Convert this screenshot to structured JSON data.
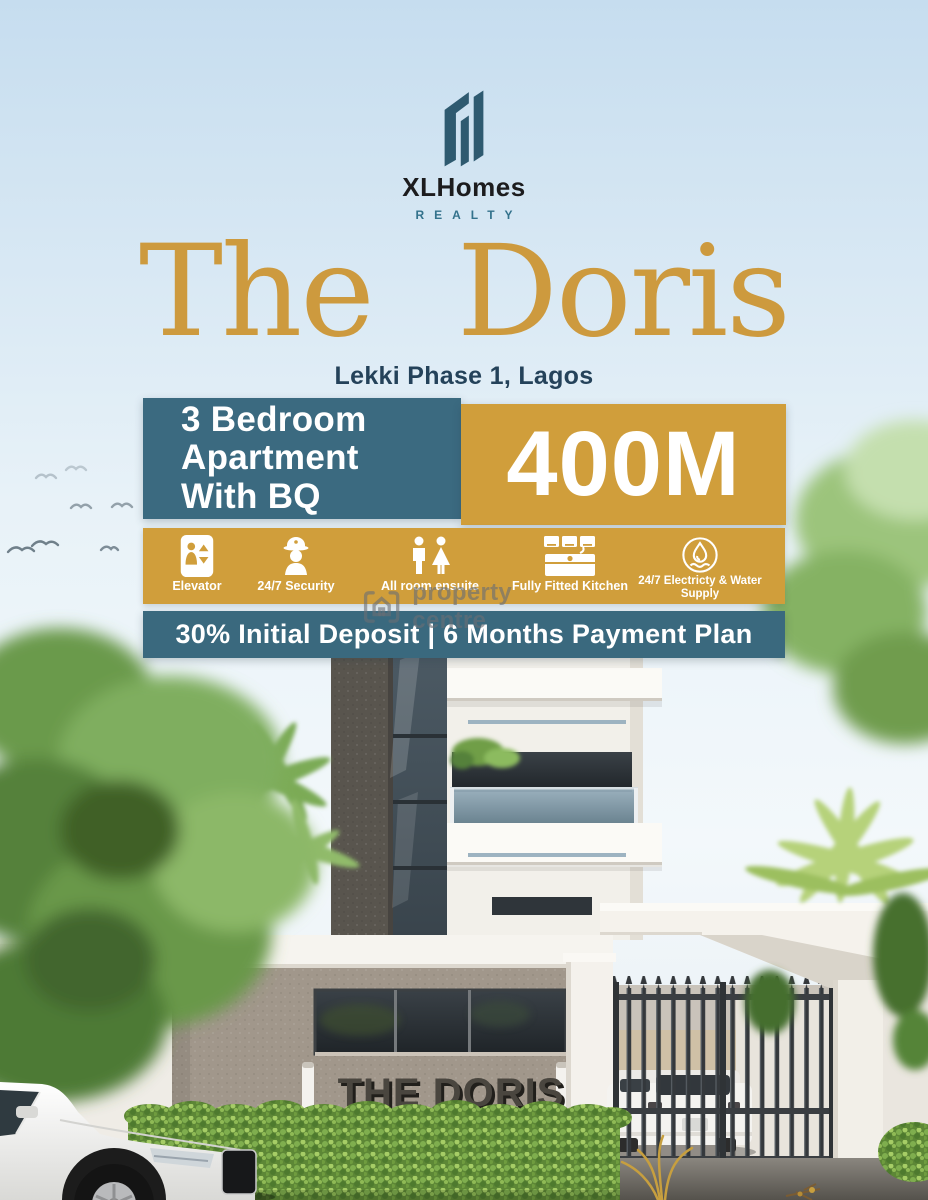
{
  "brand": {
    "name": "XLHomes",
    "division": "REALTY",
    "logo_icon": "buildings-icon"
  },
  "headline": {
    "title": "The Doris",
    "location": "Lekki Phase 1, Lagos"
  },
  "offer": {
    "unit_lines": [
      "3 Bedroom",
      "Apartment",
      "With BQ"
    ],
    "price": "400M"
  },
  "features": [
    {
      "icon": "elevator-icon",
      "label": "Elevator"
    },
    {
      "icon": "security-guard-icon",
      "label": "24/7 Security"
    },
    {
      "icon": "ensuite-icon",
      "label": "All room ensuite"
    },
    {
      "icon": "kitchen-icon",
      "label": "Fully Fitted Kitchen"
    },
    {
      "icon": "water-electricity-icon",
      "label": "24/7 Electricty & Water Supply"
    }
  ],
  "payment": "30% Initial Deposit | 6 Months Payment Plan",
  "watermark": {
    "icon": "property-centre-logo",
    "text": "property centre"
  },
  "scene": {
    "building_sign": "THE DORIS"
  },
  "colors": {
    "gold": "#d09e3b",
    "teal": "#3b6a80",
    "title_gold": "#cd9a3e",
    "location_navy": "#24425a",
    "logo_teal": "#2e5a70"
  }
}
